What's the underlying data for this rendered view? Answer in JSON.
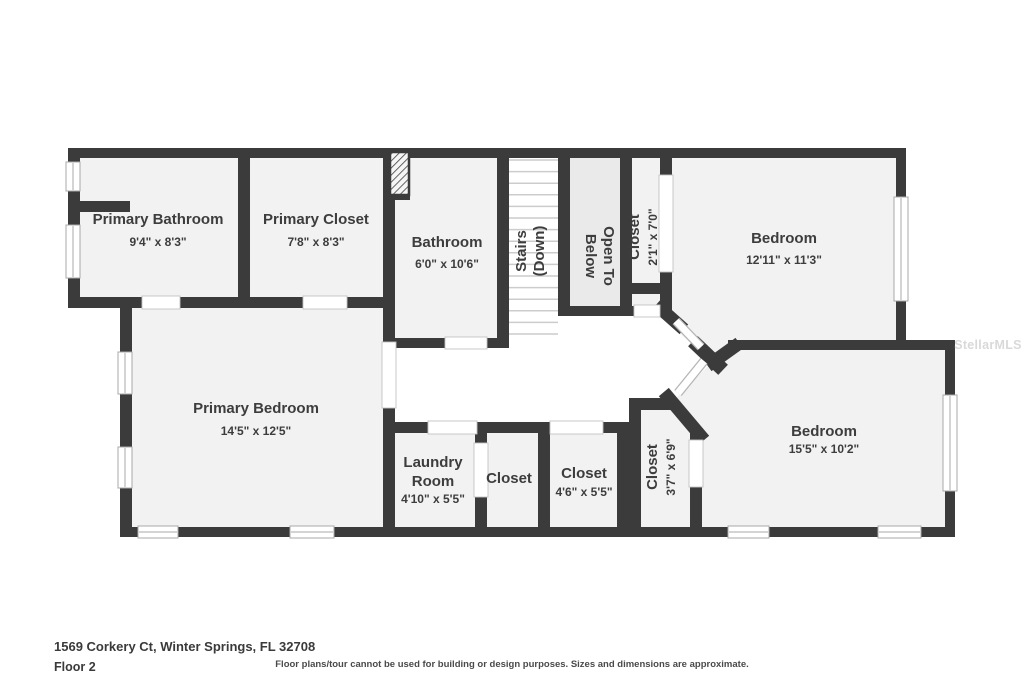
{
  "footer": {
    "address": "1569 Corkery Ct, Winter Springs, FL 32708",
    "floor_label": "Floor 2",
    "disclaimer": "Floor plans/tour cannot be used for building or design purposes. Sizes and dimensions are approximate."
  },
  "watermark": "StellarMLS",
  "colors": {
    "wall": "#3b3b3b",
    "room_fill": "#f2f2f2",
    "open_to_below_fill": "#eaeaea",
    "hall_fill": "#ffffff",
    "label_text": "#3d3d3d"
  },
  "labels": {
    "primary_bathroom": {
      "name": "Primary Bathroom",
      "dims": "9'4\" x 8'3\""
    },
    "primary_closet": {
      "name": "Primary Closet",
      "dims": "7'8\" x 8'3\""
    },
    "bathroom": {
      "name": "Bathroom",
      "dims": "6'0\" x 10'6\""
    },
    "stairs": {
      "name": "Stairs",
      "dims": "(Down)"
    },
    "open_to_below": {
      "line1": "Open To",
      "line2": "Below"
    },
    "closet_hall": {
      "name": "Closet",
      "dims": "2'1\" x 7'0\""
    },
    "bedroom_top": {
      "name": "Bedroom",
      "dims": "12'11\" x 11'3\""
    },
    "primary_bedroom": {
      "name": "Primary Bedroom",
      "dims": "14'5\" x 12'5\""
    },
    "laundry": {
      "line1": "Laundry",
      "line2": "Room",
      "dims": "4'10\" x 5'5\""
    },
    "closet_small": {
      "name": "Closet"
    },
    "closet_mid": {
      "name": "Closet",
      "dims": "4'6\" x 5'5\""
    },
    "closet_bedroom": {
      "name": "Closet",
      "dims": "3'7\" x 6'9\""
    },
    "bedroom_bottom": {
      "name": "Bedroom",
      "dims": "15'5\" x 10'2\""
    }
  }
}
